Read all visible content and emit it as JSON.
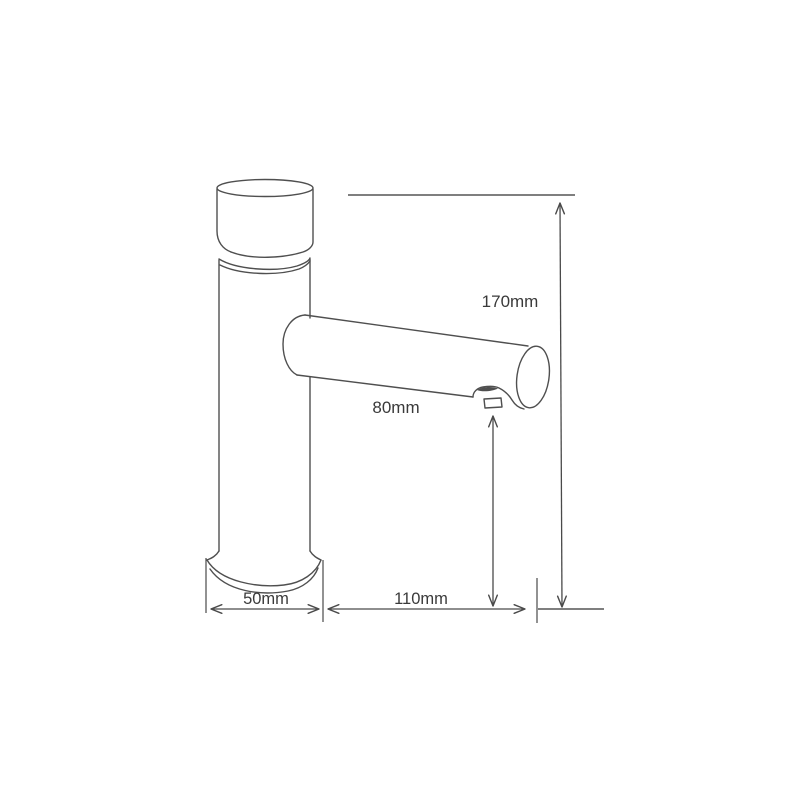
{
  "drawing": {
    "subject": "basin-faucet-line-drawing",
    "dimensions": {
      "overall_height": {
        "label": "170mm"
      },
      "spout_height": {
        "label": "80mm"
      },
      "base_width": {
        "label": "50mm"
      },
      "spout_reach": {
        "label": "110mm"
      }
    },
    "colors": {
      "outline": "#4f4f4f",
      "dimension_lines": "#4a4a4a",
      "reference_lines": "#7f7f7f",
      "text": "#3a3a3a",
      "background": "#ffffff"
    }
  }
}
